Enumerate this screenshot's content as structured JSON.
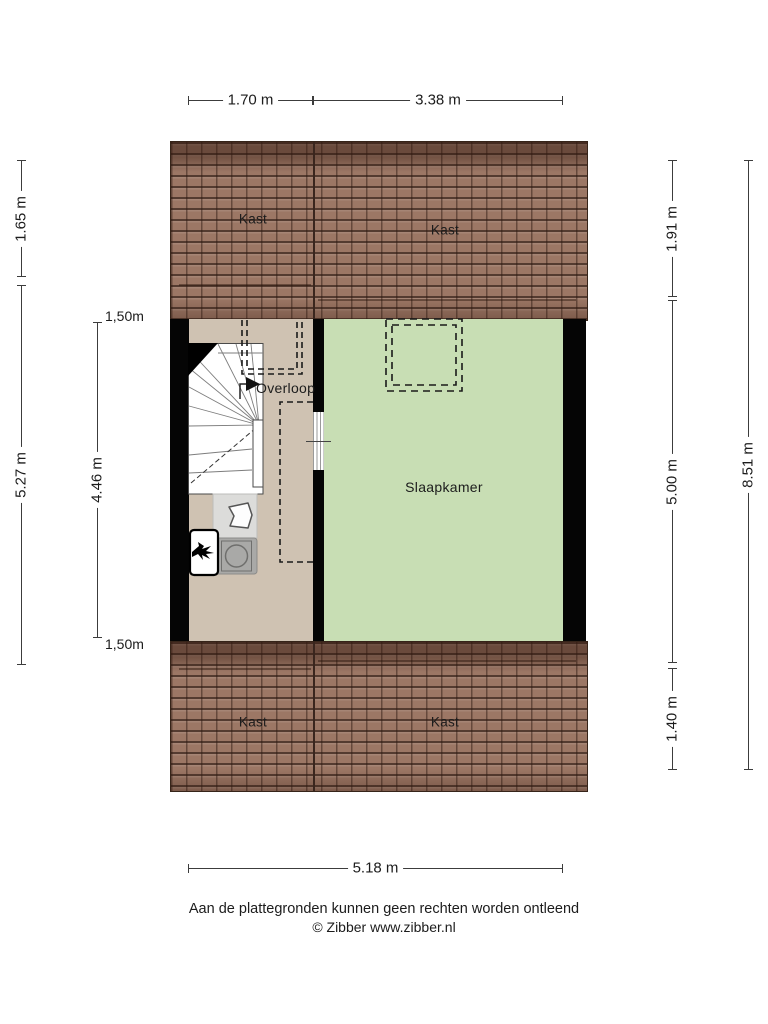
{
  "plan": {
    "rooms": {
      "kast_top_left": "Kast",
      "kast_top_right": "Kast",
      "kast_bottom_left": "Kast",
      "kast_bottom_right": "Kast",
      "overloop": "Overloop",
      "slaapkamer": "Slaapkamer"
    },
    "dimensions": {
      "top_left": "1.70 m",
      "top_right": "3.38 m",
      "bottom": "5.18 m",
      "left_roof": "1.65 m",
      "left_floor": "5.27 m",
      "left_inner_floor": "4.46 m",
      "headroom_top": "1,50m",
      "headroom_bottom": "1,50m",
      "right_roof": "1.91 m",
      "right_floor": "5.00 m",
      "right_roof_bottom": "1.40 m",
      "right_total": "8.51 m"
    },
    "colors": {
      "roof": "#9c7765",
      "overloop_floor": "#cfc2b2",
      "slaapkamer_floor": "#c8deb4",
      "wall": "#050505",
      "counter": "#dcdcda",
      "appliance": "#a9a9a7"
    },
    "icons": {
      "stairs": "winder-staircase-top-view",
      "direction_arrow": "walkline-right-arrow",
      "sink": "hand-basin-outline",
      "washer": "washing-machine-drum",
      "boiler": "cv-boiler-flame",
      "skylight": "dashed-roof-window",
      "headroom_outline": "dashed-low-headroom-contour",
      "door": "striped-door-opening"
    }
  },
  "footer": {
    "disclaimer": "Aan de plattegronden kunnen geen rechten worden ontleend",
    "copyright": "© Zibber www.zibber.nl"
  }
}
